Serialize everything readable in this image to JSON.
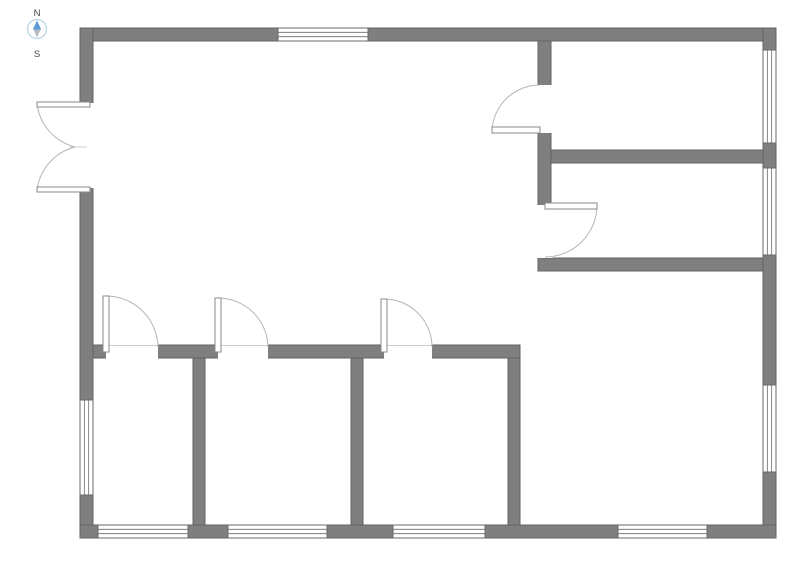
{
  "compass": {
    "north_label": "N",
    "south_label": "S"
  },
  "colors": {
    "background": "#ffffff",
    "wall_fill": "#7f7f7f",
    "wall_stroke": "#636363",
    "opening_fill": "#ffffff",
    "window_fill": "#ffffff",
    "window_frame": "#6a6a6a",
    "door_panel_fill": "#ffffff",
    "door_panel_stroke": "#8a8a8a",
    "door_arc": "#b5b5b5",
    "threshold_line": "#cccccc",
    "compass_ring": "#b9d6e6",
    "compass_north": "#5b9bd5",
    "compass_north_stroke": "#2e6da4",
    "compass_south": "#b3bcc2",
    "compass_south_stroke": "#9aa4ab"
  },
  "floorplan": {
    "walls": [
      {
        "name": "wall-exterior-top",
        "x": 80,
        "y": 28,
        "w": 696,
        "h": 13
      },
      {
        "name": "wall-exterior-left",
        "x": 80,
        "y": 28,
        "w": 13,
        "h": 510
      },
      {
        "name": "wall-exterior-right",
        "x": 763,
        "y": 28,
        "w": 13,
        "h": 510
      },
      {
        "name": "wall-exterior-bottom",
        "x": 80,
        "y": 525,
        "w": 696,
        "h": 13
      },
      {
        "name": "wall-interior-vertical-entry",
        "x": 538,
        "y": 41,
        "w": 13,
        "h": 217
      },
      {
        "name": "wall-interior-right-rooms-divider",
        "x": 551,
        "y": 150,
        "w": 212,
        "h": 13
      },
      {
        "name": "wall-interior-right-rooms-bottom",
        "x": 538,
        "y": 258,
        "w": 225,
        "h": 13
      },
      {
        "name": "wall-interior-bottom-rooms-top",
        "x": 93,
        "y": 345,
        "w": 427,
        "h": 13
      },
      {
        "name": "wall-interior-bottom-divider-1",
        "x": 193,
        "y": 358,
        "w": 12,
        "h": 167
      },
      {
        "name": "wall-interior-bottom-divider-2",
        "x": 351,
        "y": 358,
        "w": 12,
        "h": 167
      },
      {
        "name": "wall-interior-bottom-rooms-right",
        "x": 508,
        "y": 358,
        "w": 12,
        "h": 167
      }
    ],
    "openings": [
      {
        "name": "opening-double-door",
        "x": 78.5,
        "y": 103,
        "w": 16,
        "h": 85
      },
      {
        "name": "opening-door-entry-top",
        "x": 536.5,
        "y": 85,
        "w": 16,
        "h": 48
      },
      {
        "name": "opening-door-entry-bottom",
        "x": 536.5,
        "y": 205,
        "w": 16,
        "h": 53
      },
      {
        "name": "opening-door-room-1",
        "x": 106,
        "y": 343.5,
        "w": 52,
        "h": 16
      },
      {
        "name": "opening-door-room-2",
        "x": 218,
        "y": 343.5,
        "w": 50,
        "h": 16
      },
      {
        "name": "opening-door-room-3",
        "x": 384,
        "y": 343.5,
        "w": 48,
        "h": 16
      }
    ],
    "windows": [
      {
        "name": "window-top",
        "x": 278,
        "y": 28,
        "w": 90,
        "h": 13,
        "orient": "h"
      },
      {
        "name": "window-right-1",
        "x": 763,
        "y": 50,
        "w": 13,
        "h": 93,
        "orient": "v"
      },
      {
        "name": "window-right-2",
        "x": 763,
        "y": 168,
        "w": 13,
        "h": 87,
        "orient": "v"
      },
      {
        "name": "window-right-3",
        "x": 763,
        "y": 385,
        "w": 13,
        "h": 87,
        "orient": "v"
      },
      {
        "name": "window-left",
        "x": 80,
        "y": 400,
        "w": 13,
        "h": 95,
        "orient": "v"
      },
      {
        "name": "window-bottom-1",
        "x": 98,
        "y": 525,
        "w": 90,
        "h": 13,
        "orient": "h"
      },
      {
        "name": "window-bottom-2",
        "x": 228,
        "y": 525,
        "w": 99,
        "h": 13,
        "orient": "h"
      },
      {
        "name": "window-bottom-3",
        "x": 393,
        "y": 525,
        "w": 92,
        "h": 13,
        "orient": "h"
      },
      {
        "name": "window-bottom-4",
        "x": 618,
        "y": 525,
        "w": 89,
        "h": 13,
        "orient": "h"
      }
    ],
    "doors": [
      {
        "name": "door-double-left-top-leaf",
        "panel": {
          "x": 37,
          "y": 102,
          "w": 53,
          "h": 5
        },
        "arc": "M37,104 A51,51 0 0 0 75,147"
      },
      {
        "name": "door-double-left-bottom-leaf",
        "panel": {
          "x": 37,
          "y": 187,
          "w": 53,
          "h": 5
        },
        "arc": "M37,190 A51,51 0 0 1 75,147"
      },
      {
        "name": "door-entry-top",
        "panel": {
          "x": 492,
          "y": 127,
          "w": 48,
          "h": 6
        },
        "arc": "M492,130 A48,48 0 0 1 540,85"
      },
      {
        "name": "door-entry-bottom",
        "panel": {
          "x": 545,
          "y": 203,
          "w": 52,
          "h": 6
        },
        "arc": "M597,206 A52,52 0 0 1 545,257"
      },
      {
        "name": "door-room-1",
        "panel": {
          "x": 103,
          "y": 296,
          "w": 6,
          "h": 56
        },
        "arc": "M106,296 A52,52 0 0 1 158,347"
      },
      {
        "name": "door-room-2",
        "panel": {
          "x": 215,
          "y": 298,
          "w": 6,
          "h": 54
        },
        "arc": "M218,298 A50,50 0 0 1 268,347"
      },
      {
        "name": "door-room-3",
        "panel": {
          "x": 381,
          "y": 299,
          "w": 6,
          "h": 53
        },
        "arc": "M384,299 A48,48 0 0 1 432,347"
      }
    ],
    "thresholds": [
      {
        "name": "threshold-door-room-1",
        "x1": 106,
        "y1": 345.5,
        "x2": 158,
        "y2": 345.5
      },
      {
        "name": "threshold-door-room-2",
        "x1": 218,
        "y1": 345.5,
        "x2": 268,
        "y2": 345.5
      },
      {
        "name": "threshold-door-room-3",
        "x1": 384,
        "y1": 345.5,
        "x2": 432,
        "y2": 345.5
      },
      {
        "name": "double-door-meeting-tick",
        "x1": 70,
        "y1": 147,
        "x2": 87,
        "y2": 147
      }
    ]
  }
}
